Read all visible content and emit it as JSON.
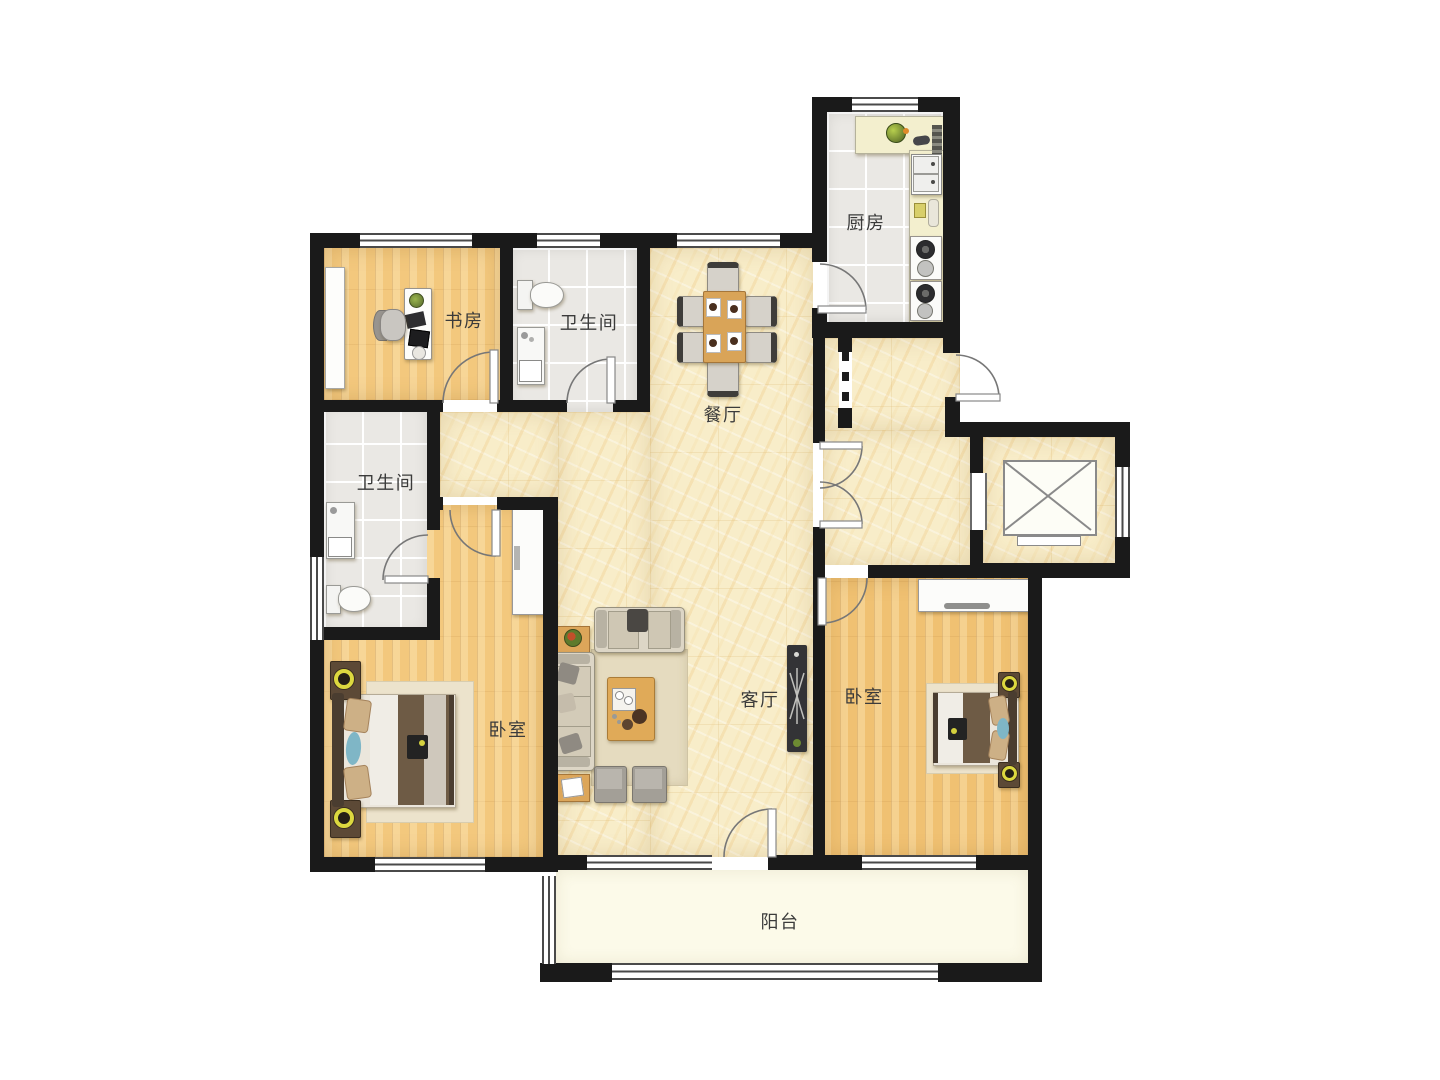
{
  "plan": {
    "rooms": {
      "study": {
        "label": "书房"
      },
      "bathroom_top": {
        "label": "卫生间"
      },
      "dining": {
        "label": "餐厅"
      },
      "kitchen": {
        "label": "厨房"
      },
      "bathroom_left": {
        "label": "卫生间"
      },
      "bedroom_left": {
        "label": "卧室"
      },
      "living": {
        "label": "客厅"
      },
      "bedroom_right": {
        "label": "卧室"
      },
      "balcony": {
        "label": "阳台"
      }
    },
    "colors": {
      "wall": "#1a1a1a",
      "marble_floor": "#f8edc9",
      "wood_floor": "#f3c87d",
      "tile_floor": "#eae8e4",
      "balcony_floor": "#fcfae9",
      "counter": "#f3efce",
      "accent_lamp": "#dcd83f",
      "accent_blue": "#7fb6c6"
    }
  }
}
